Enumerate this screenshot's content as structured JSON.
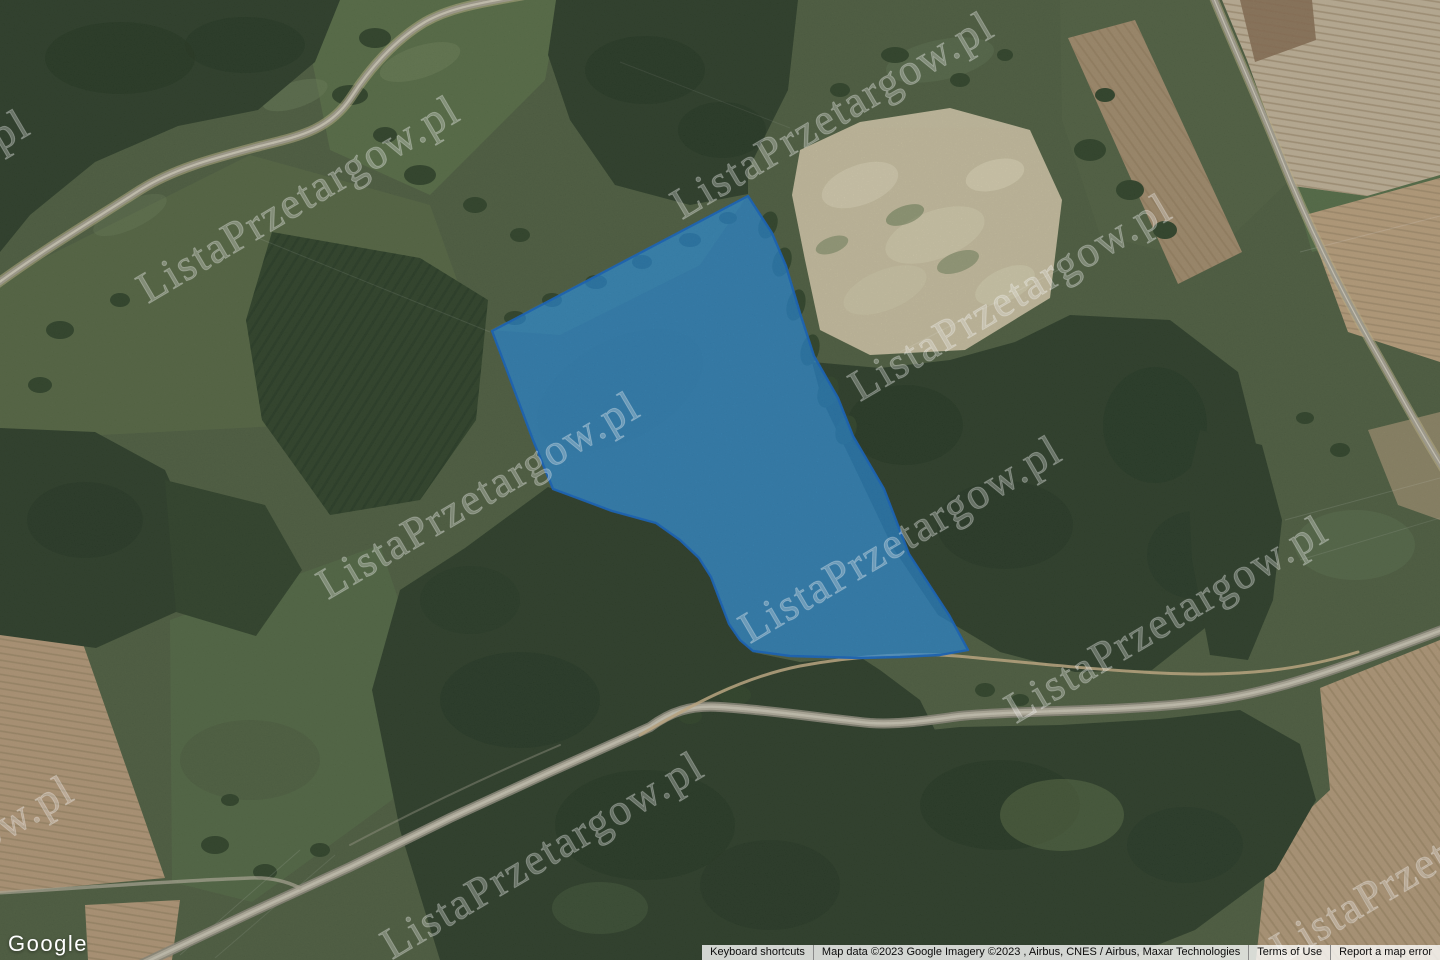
{
  "watermark": {
    "text": "ListaPrzetargow.pl"
  },
  "branding": {
    "logo": "Google"
  },
  "attribution": {
    "keyboard_shortcuts": "Keyboard shortcuts",
    "map_data": "Map data ©2023 Google Imagery ©2023 , Airbus, CNES / Airbus, Maxar Technologies",
    "terms_of_use": "Terms of Use",
    "report_error": "Report a map error"
  },
  "parcel": {
    "fill": "#2090ec",
    "stroke": "#1565c0",
    "points": "492,331 748,196 772,233 786,266 800,313 814,356 838,398 853,436 884,489 909,554 949,615 968,650 940,655 900,657 860,658 790,656 753,651 740,640 729,624 719,598 711,577 699,558 680,540 656,523 612,511 580,499 553,489 533,440 515,392 500,352"
  },
  "map_colors": {
    "field_base": "#4e5f40",
    "forest": "#2c3e28",
    "plowed_tan": "#c3b49a",
    "road_gray": "#a6a290"
  }
}
